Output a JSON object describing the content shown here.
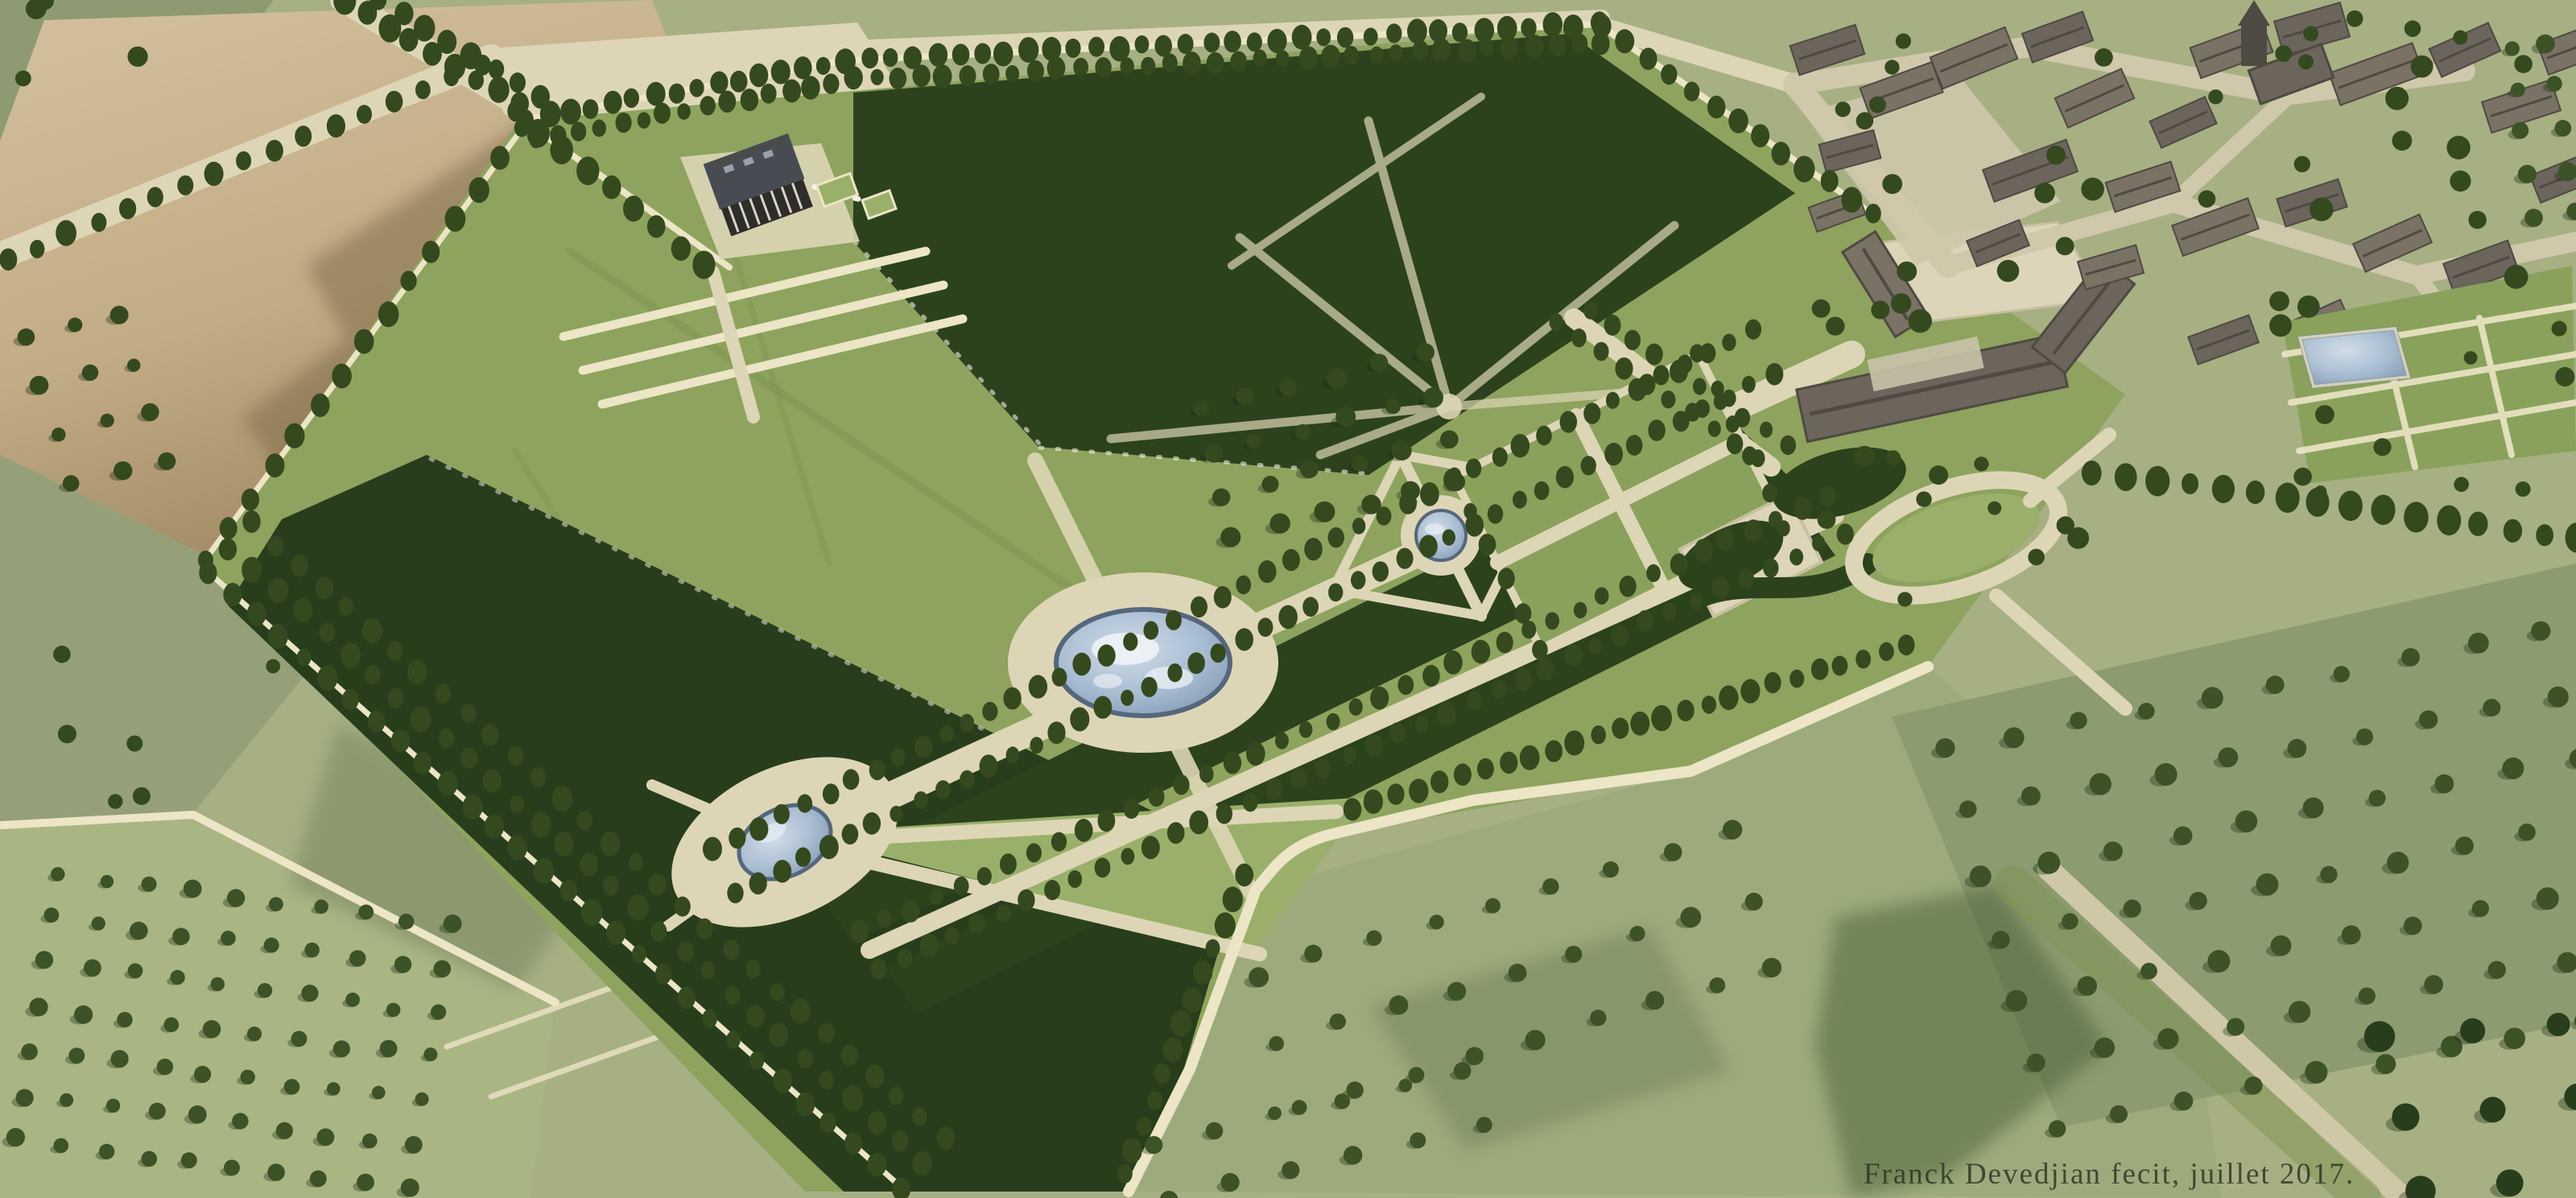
{
  "signature": {
    "text": "Franck Devedjian fecit, juillet 2017."
  },
  "palette": {
    "base": "#a6b083",
    "field_gray": "#95a078",
    "field_gray2": "#8e9a72",
    "field_pale": "#aab584",
    "field_light": "#9dab7c",
    "orchard_ground": "#8d9b70",
    "tan_light": "#cfbd9a",
    "tan_dark": "#9f8860",
    "brown": "#7c6747",
    "lawn": "#8ea35e",
    "lawn_light": "#9ab06a",
    "parterre": "#8aa15c",
    "bosquet": "#2c421d",
    "forest": "#283d1b",
    "tree": "#35491f",
    "orchard_tree": "#3d5226",
    "path": "#ddd6b6",
    "path_deep": "#cfc8a6",
    "wall": "#ece5c6",
    "track": "#7d9352",
    "pool_edge": "#55677a",
    "pool_hi": "#cdd9e6",
    "pool_mid": "#a9bdd2",
    "pool_lo": "#7e97b2",
    "roof": "#6b655c",
    "roof2": "#7a7264",
    "roof_dark": "#4f4a42",
    "slate": "#474c52",
    "facade": "#2f2d2a",
    "court": "#ddd5ba",
    "road_village": "#cfc8ab",
    "dark_patch": "#41582f",
    "signature": "#2c3322"
  },
  "scene": {
    "tree_rows": [
      [
        655,
        148,
        1050,
        75,
        16,
        11
      ],
      [
        1050,
        75,
        1985,
        30,
        34,
        11
      ],
      [
        668,
        172,
        1060,
        99,
        16,
        10
      ],
      [
        1060,
        99,
        1990,
        54,
        34,
        10
      ],
      [
        1992,
        34,
        2326,
        266,
        13,
        11
      ],
      [
        428,
        2,
        646,
        130,
        9,
        12
      ],
      [
        472,
        0,
        672,
        118,
        8,
        12
      ],
      [
        10,
        322,
        600,
        80,
        17,
        11
      ],
      [
        650,
        158,
        255,
        695,
        15,
        11
      ],
      [
        258,
        710,
        1120,
        1475,
        30,
        11
      ],
      [
        285,
        680,
        1147,
        1445,
        30,
        11
      ],
      [
        312,
        650,
        1174,
        1415,
        30,
        11
      ],
      [
        887,
        1056,
        2177,
        411,
        46,
        10
      ],
      [
        913,
        1110,
        2203,
        465,
        46,
        10
      ],
      [
        1069,
        1157,
        2269,
        617,
        40,
        10
      ],
      [
        1091,
        1203,
        2291,
        663,
        40,
        10
      ],
      [
        2370,
        800,
        1680,
        1005,
        26,
        11
      ],
      [
        1545,
        1085,
        1395,
        1460,
        13,
        11
      ],
      [
        2600,
        585,
        3200,
        668,
        16,
        13
      ],
      [
        640,
        140,
        875,
        330,
        9,
        12
      ],
      [
        2110,
        440,
        2218,
        654,
        6,
        10
      ],
      [
        1806,
        592,
        1914,
        806,
        6,
        10
      ],
      [
        1935,
        400,
        2185,
        570,
        10,
        10
      ],
      [
        1975,
        385,
        2220,
        555,
        10,
        10
      ]
    ],
    "orchards": [
      [
        75,
        1085,
        10,
        7,
        54,
        7,
        -9,
        55,
        10,
        "orchard_tree"
      ],
      [
        2420,
        930,
        10,
        7,
        82,
        -16,
        22,
        78,
        12,
        "orchard_tree"
      ],
      [
        2960,
        1290,
        4,
        3,
        110,
        -10,
        25,
        95,
        17,
        "forest"
      ],
      [
        1560,
        1210,
        9,
        3,
        74,
        -22,
        26,
        84,
        11,
        "orchard_tree"
      ],
      [
        1430,
        1420,
        6,
        2,
        78,
        -18,
        20,
        70,
        10,
        "orchard_tree"
      ],
      [
        3118,
        60,
        2,
        5,
        46,
        -6,
        8,
        52,
        10,
        "orchard_tree"
      ],
      [
        30,
        420,
        3,
        4,
        60,
        -15,
        20,
        60,
        10,
        "tree"
      ],
      [
        1490,
        510,
        6,
        4,
        56,
        -14,
        14,
        52,
        11,
        "tree"
      ]
    ],
    "scatters": [
      [
        2230,
        20,
        960,
        390,
        40,
        12,
        7
      ],
      [
        2250,
        560,
        380,
        200,
        11,
        11,
        13
      ],
      [
        0,
        0,
        200,
        120,
        4,
        12,
        3
      ],
      [
        30,
        780,
        350,
        220,
        6,
        10,
        9
      ],
      [
        2860,
        430,
        330,
        200,
        8,
        10,
        29
      ]
    ],
    "village_buildings": [
      [
        2270,
        62,
        85,
        38,
        -18,
        0
      ],
      [
        2362,
        112,
        95,
        40,
        -20,
        1
      ],
      [
        2298,
        188,
        70,
        36,
        -15,
        0
      ],
      [
        2452,
        72,
        100,
        42,
        -22,
        1
      ],
      [
        2556,
        46,
        80,
        38,
        -20,
        0
      ],
      [
        2602,
        122,
        90,
        40,
        -24,
        1
      ],
      [
        2522,
        212,
        110,
        42,
        -20,
        0
      ],
      [
        2662,
        232,
        85,
        38,
        -18,
        1
      ],
      [
        2712,
        152,
        75,
        36,
        -24,
        0
      ],
      [
        2772,
        62,
        95,
        40,
        -20,
        1
      ],
      [
        2872,
        36,
        85,
        44,
        -16,
        0
      ],
      [
        2952,
        92,
        110,
        42,
        -20,
        1
      ],
      [
        3062,
        62,
        80,
        38,
        -24,
        0
      ],
      [
        3132,
        132,
        90,
        40,
        -18,
        1
      ],
      [
        3182,
        222,
        70,
        36,
        -22,
        0
      ],
      [
        2752,
        282,
        100,
        40,
        -20,
        1
      ],
      [
        2872,
        252,
        80,
        36,
        -18,
        0
      ],
      [
        2972,
        302,
        90,
        38,
        -24,
        1
      ],
      [
        3082,
        332,
        85,
        40,
        -20,
        0
      ],
      [
        2622,
        332,
        75,
        36,
        -16,
        1
      ],
      [
        2482,
        302,
        70,
        34,
        -22,
        0
      ],
      [
        3152,
        422,
        80,
        36,
        -20,
        1
      ],
      [
        3002,
        432,
        75,
        34,
        -18,
        0
      ],
      [
        2882,
        402,
        70,
        34,
        -24,
        1
      ],
      [
        2762,
        422,
        80,
        36,
        -20,
        0
      ],
      [
        2282,
        262,
        64,
        32,
        -20,
        1
      ],
      [
        3192,
        62,
        70,
        40,
        -20,
        1
      ]
    ]
  }
}
